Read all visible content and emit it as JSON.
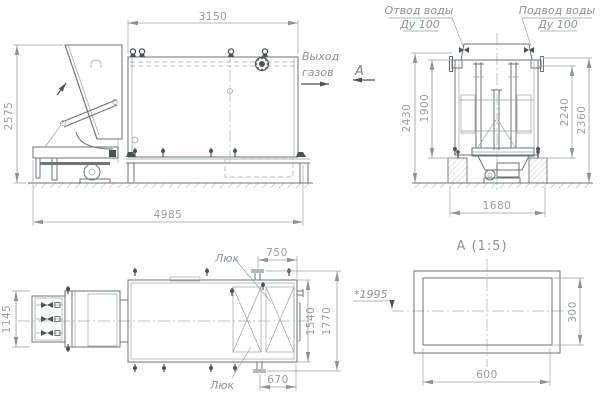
{
  "drawing": {
    "side_view": {
      "dim_width_top": "3150",
      "dim_height_left": "2575",
      "dim_width_bottom": "4985",
      "gas_note_line1": "Выход",
      "gas_note_line2": "газов",
      "view_arrow_label": "А"
    },
    "end_view": {
      "outlet_label_line1": "Отвод воды",
      "outlet_label_line2": "Ду 100",
      "inlet_label_line1": "Подвод воды",
      "inlet_label_line2": "Ду 100",
      "dim_left_outer": "2430",
      "dim_left_inner": "1900",
      "dim_right_inner": "2240",
      "dim_right_outer": "2360",
      "dim_foundation": "1680"
    },
    "plan_view": {
      "dim_mechanism": "1145",
      "dim_hatch_top": "750",
      "dim_hatch_bottom": "670",
      "dim_body_inner": "1540",
      "dim_body_outer": "1770",
      "dim_note": "*1995",
      "hatch_label_top": "Люк",
      "hatch_label_bottom": "Люк"
    },
    "section_view": {
      "title": "А  (1:5)",
      "dim_width": "600",
      "dim_height": "300"
    },
    "colors": {
      "line": "#6e7377",
      "thin": "#9aa0a4",
      "dark": "#4d5256",
      "text": "#989da0",
      "background": "#ffffff"
    }
  }
}
